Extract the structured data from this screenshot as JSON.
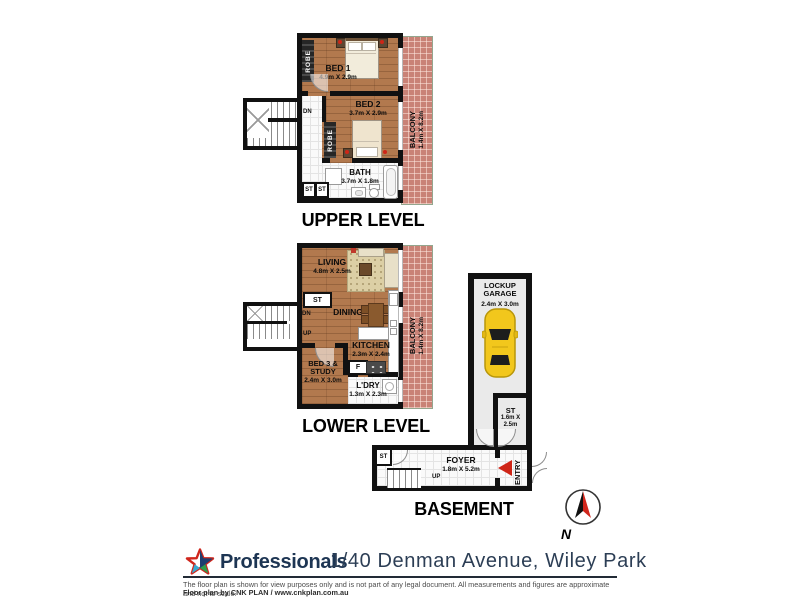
{
  "upper": {
    "title": "UPPER LEVEL",
    "bed1": {
      "name": "BED 1",
      "dim": "4.9m X 2.9m"
    },
    "bed2": {
      "name": "BED 2",
      "dim": "3.7m X 2.9m"
    },
    "bath": {
      "name": "BATH",
      "dim": "3.7m X 1.8m"
    },
    "balcony": {
      "name": "BALCONY",
      "dim": "1.4m X 8.2m"
    },
    "robe1": "ROBE",
    "robe2": "ROBE",
    "dn": "DN",
    "st1": "ST",
    "st2": "ST"
  },
  "lower": {
    "title": "LOWER LEVEL",
    "living": {
      "name": "LIVING",
      "dim": "4.8m X 2.5m"
    },
    "dining": {
      "name": "DINING"
    },
    "kitchen": {
      "name": "KITCHEN",
      "dim": "2.3m X 2.4m"
    },
    "bed3": {
      "line1": "BED 3 &",
      "line2": "STUDY",
      "dim": "2.4m X 3.0m"
    },
    "laundry": {
      "name": "L'DRY",
      "dim": "1.3m X 2.3m"
    },
    "balcony": {
      "name": "BALCONY",
      "dim": "1.4m X 8.2m"
    },
    "st": "ST",
    "dn": "DN",
    "up": "UP",
    "fridge": "F"
  },
  "basement": {
    "title": "BASEMENT",
    "garage": {
      "line1": "LOCKUP",
      "line2": "GARAGE",
      "dim": "2.4m X 3.0m"
    },
    "storage": {
      "name": "ST",
      "dim": "1.6m X 2.5m"
    },
    "foyer": {
      "name": "FOYER",
      "dim": "1.8m X 5.2m"
    },
    "entry": "ENTRY",
    "st": "ST",
    "up": "UP"
  },
  "compass": {
    "label": "N"
  },
  "footer": {
    "brand": "Professionals",
    "address": "1/40 Denman Avenue, Wiley Park",
    "disclaimer": "The floor plan is shown for view purposes only and is not part of any legal document. All measurements and figures are approximate and not to scale.",
    "credit": "Floor plan by CNK PLAN / www.cnkplan.com.au"
  },
  "colors": {
    "wall": "#111111",
    "wood": "#b2794e",
    "balcony_tile": "#c98276",
    "accent_red": "#cf2517",
    "brand_navy": "#1d3553",
    "car_yellow": "#f2c71c"
  }
}
